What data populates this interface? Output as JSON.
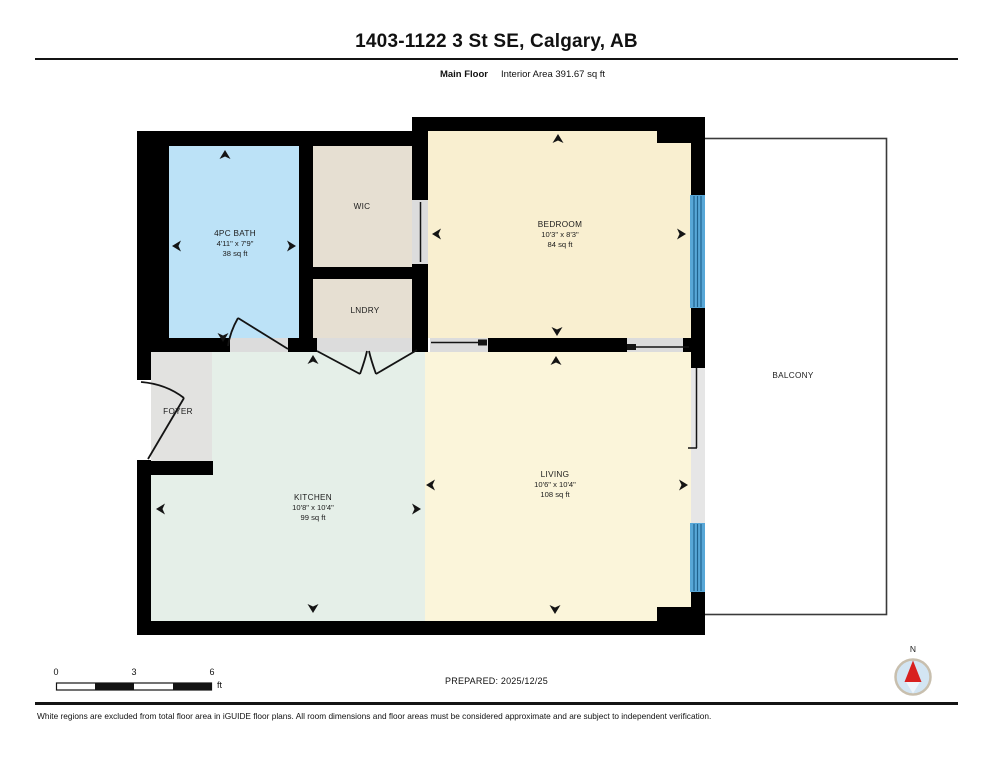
{
  "header": {
    "title": "1403-1122 3 St SE, Calgary, AB",
    "floor_label": "Main Floor",
    "area_label": "Interior Area 391.67 sq ft"
  },
  "rooms": {
    "bath": {
      "name": "4PC BATH",
      "dims": "4'11\" x 7'9\"",
      "area": "38 sq ft"
    },
    "wic": {
      "name": "WIC"
    },
    "laundry": {
      "name": "LNDRY"
    },
    "bedroom": {
      "name": "BEDROOM",
      "dims": "10'3\" x 8'3\"",
      "area": "84 sq ft"
    },
    "foyer": {
      "name": "FOYER"
    },
    "kitchen": {
      "name": "KITCHEN",
      "dims": "10'8\" x 10'4\"",
      "area": "99 sq ft"
    },
    "living": {
      "name": "LIVING",
      "dims": "10'6\" x 10'4\"",
      "area": "108 sq ft"
    },
    "balcony": {
      "name": "BALCONY"
    }
  },
  "scale_bar": {
    "labels": [
      "0",
      "3",
      "6"
    ],
    "unit": "ft"
  },
  "prepared_label": "PREPARED: 2025/12/25",
  "compass": {
    "north_label": "N"
  },
  "footer": {
    "disclaimer": "White regions are excluded from total floor area in iGUIDE floor plans. All room dimensions and floor areas must be considered approximate and are subject to independent verification."
  },
  "colors": {
    "wall": "#000000",
    "bath": "#bce2f7",
    "closet": "#e6dfd2",
    "bedroom": "#f9efd0",
    "living": "#fbf5da",
    "kitchen": "#e5efe8",
    "foyer": "#e2e2e0",
    "threshold": "#dcdcdc",
    "window": "#58a7d7",
    "window_line": "#1f628e",
    "balcony_outline": "#3a3a3a"
  }
}
